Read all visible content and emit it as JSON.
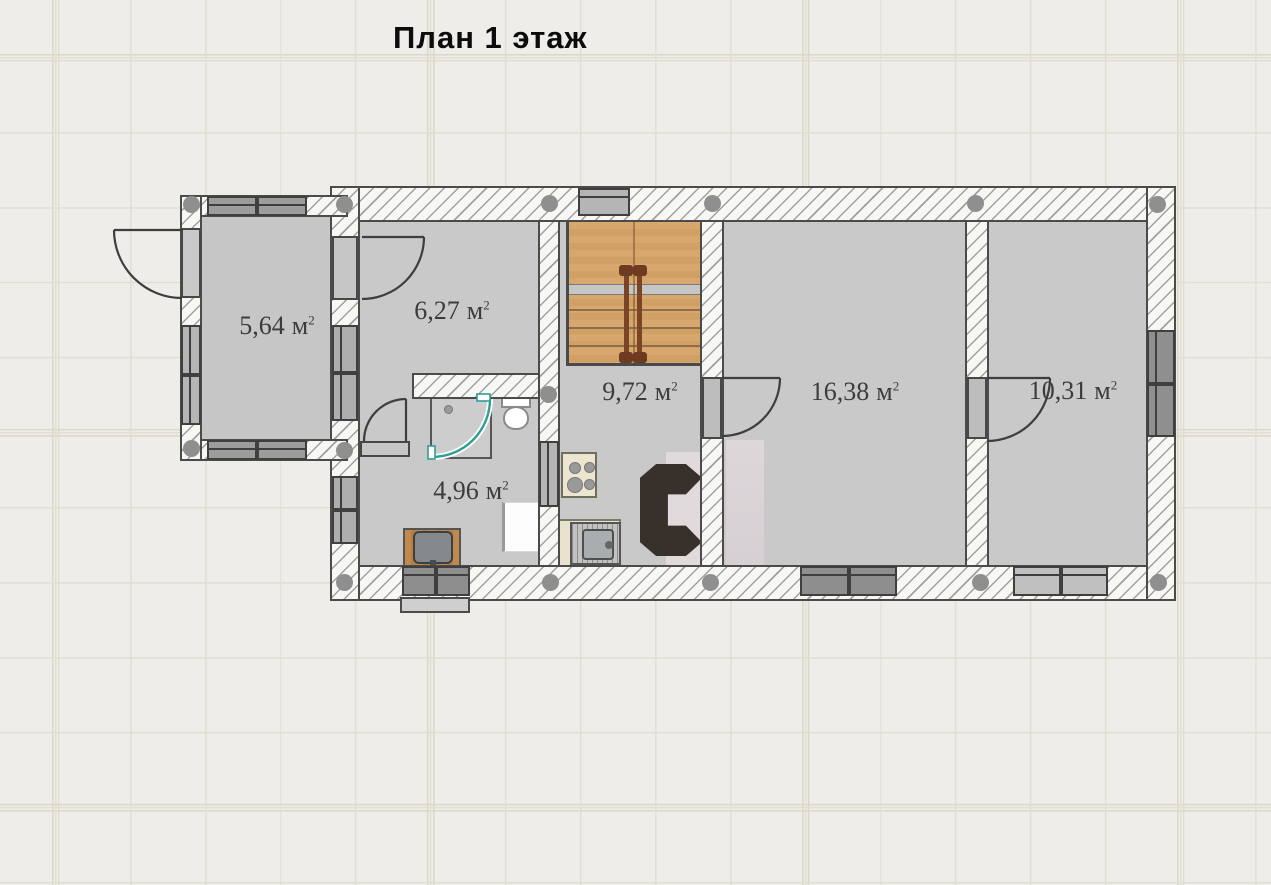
{
  "title": "План 1 этаж",
  "rooms": [
    {
      "area": "5,64",
      "unit": "м",
      "sup": "2"
    },
    {
      "area": "6,27",
      "unit": "м",
      "sup": "2"
    },
    {
      "area": "4,96",
      "unit": "м",
      "sup": "2"
    },
    {
      "area": "9,72",
      "unit": "м",
      "sup": "2"
    },
    {
      "area": "16,38",
      "unit": "м",
      "sup": "2"
    },
    {
      "area": "10,31",
      "unit": "м",
      "sup": "2"
    }
  ],
  "colors": {
    "canvas_bg": "#eeede9",
    "grid_line": "#e2dfd2",
    "wall_fill": "#f7f7f4",
    "wall_line": "#4b4b4b",
    "room_fill": "#c9c9c9",
    "window_fill": "#b5b5b5",
    "window_dark": "#8e8e8e",
    "stair_wood": "#d8a76e",
    "stair_rail": "#7a4526",
    "shower_glass": "#2f9e94",
    "fireplace_marble": "#e0dadd",
    "fireplace_masonry": "#38302a",
    "label_color": "#3c3c3c"
  }
}
